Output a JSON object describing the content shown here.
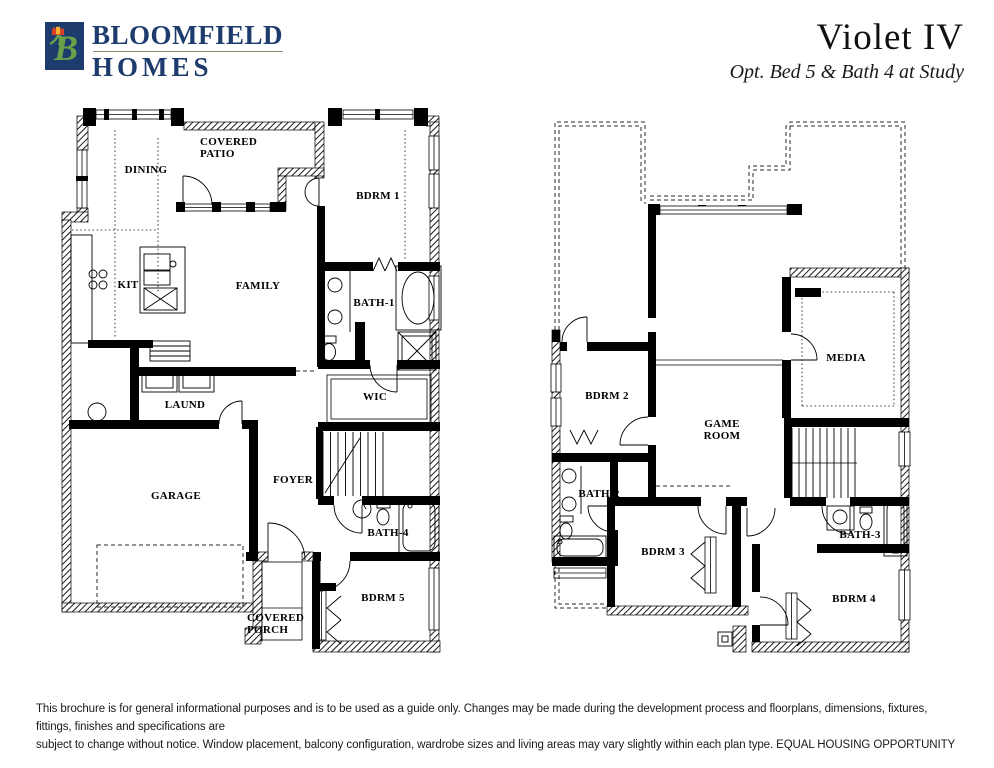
{
  "header": {
    "brand": {
      "line1": "BLOOMFIELD",
      "line2": "HOMES",
      "logo_icon": "bloomfield-b-tulip-logo",
      "colors": {
        "navy": "#1d3c6d",
        "green": "#69a04a",
        "tulip_red": "#d84328",
        "tulip_yellow": "#f7b32b"
      }
    },
    "title": "Violet IV",
    "subtitle": "Opt. Bed 5 & Bath 4 at Study"
  },
  "plans": {
    "first": {
      "name": "First Floor",
      "rooms": [
        {
          "label": "DINING"
        },
        {
          "label": "COVERED PATIO"
        },
        {
          "label": "BDRM 1"
        },
        {
          "label": "KIT"
        },
        {
          "label": "FAMILY"
        },
        {
          "label": "BATH-1"
        },
        {
          "label": "LAUND"
        },
        {
          "label": "WIC"
        },
        {
          "label": "FOYER"
        },
        {
          "label": "GARAGE"
        },
        {
          "label": "BATH-4"
        },
        {
          "label": "BDRM 5"
        },
        {
          "label": "COVERED PORCH"
        }
      ]
    },
    "second": {
      "name": "Second Floor",
      "rooms": [
        {
          "label": "BDRM 2"
        },
        {
          "label": "GAME ROOM"
        },
        {
          "label": "MEDIA"
        },
        {
          "label": "BATH-2"
        },
        {
          "label": "BDRM 3"
        },
        {
          "label": "BATH-3"
        },
        {
          "label": "BDRM 4"
        }
      ]
    }
  },
  "footer": {
    "line1": "This brochure is for general informational purposes and is to be used as a guide only. Changes may be made during the development process and floorplans, dimensions, fixtures, fittings, finishes and specifications are",
    "line2": "subject to change without notice. Window placement, balcony configuration, wardrobe sizes and living areas may vary slightly within each plan type.  EQUAL HOUSING OPPORTUNITY"
  }
}
